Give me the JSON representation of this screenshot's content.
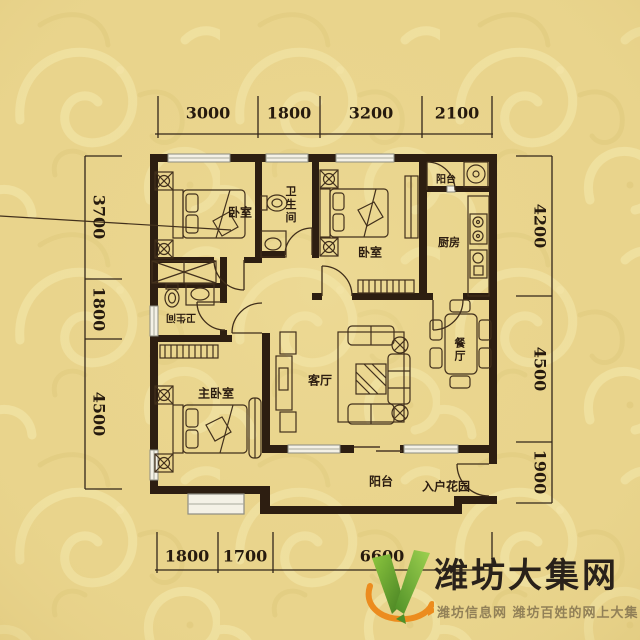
{
  "dimensions": {
    "top": [
      "3000",
      "1800",
      "3200",
      "2100"
    ],
    "left": [
      "3700",
      "1800",
      "4500"
    ],
    "right": [
      "4200",
      "4500",
      "1900"
    ],
    "bottom": [
      "1800",
      "1700",
      "6600"
    ]
  },
  "rooms": {
    "bedroom_top_left": "卧室",
    "bathroom_top": "卫生间",
    "bedroom_middle": "卧室",
    "kitchen": "厨房",
    "balcony_top": "阳台",
    "bathroom_left": "卫生间",
    "living_room": "客厅",
    "dining_room": "餐厅",
    "master_bedroom": "主卧室",
    "balcony_bottom": "阳台",
    "entry_garden": "入户花园"
  },
  "watermark": {
    "site_name": "潍坊大集网",
    "tagline": "潍坊信息网 潍坊百姓的网上大集"
  },
  "colors": {
    "background": "#e9d48c",
    "wall": "#2d1e11",
    "dimension_text": "#261a0e",
    "logo_green": "#63a434",
    "logo_orange": "#ec8c1e",
    "logo_text": "#29211a",
    "tagline_text": "#8d7c55"
  }
}
